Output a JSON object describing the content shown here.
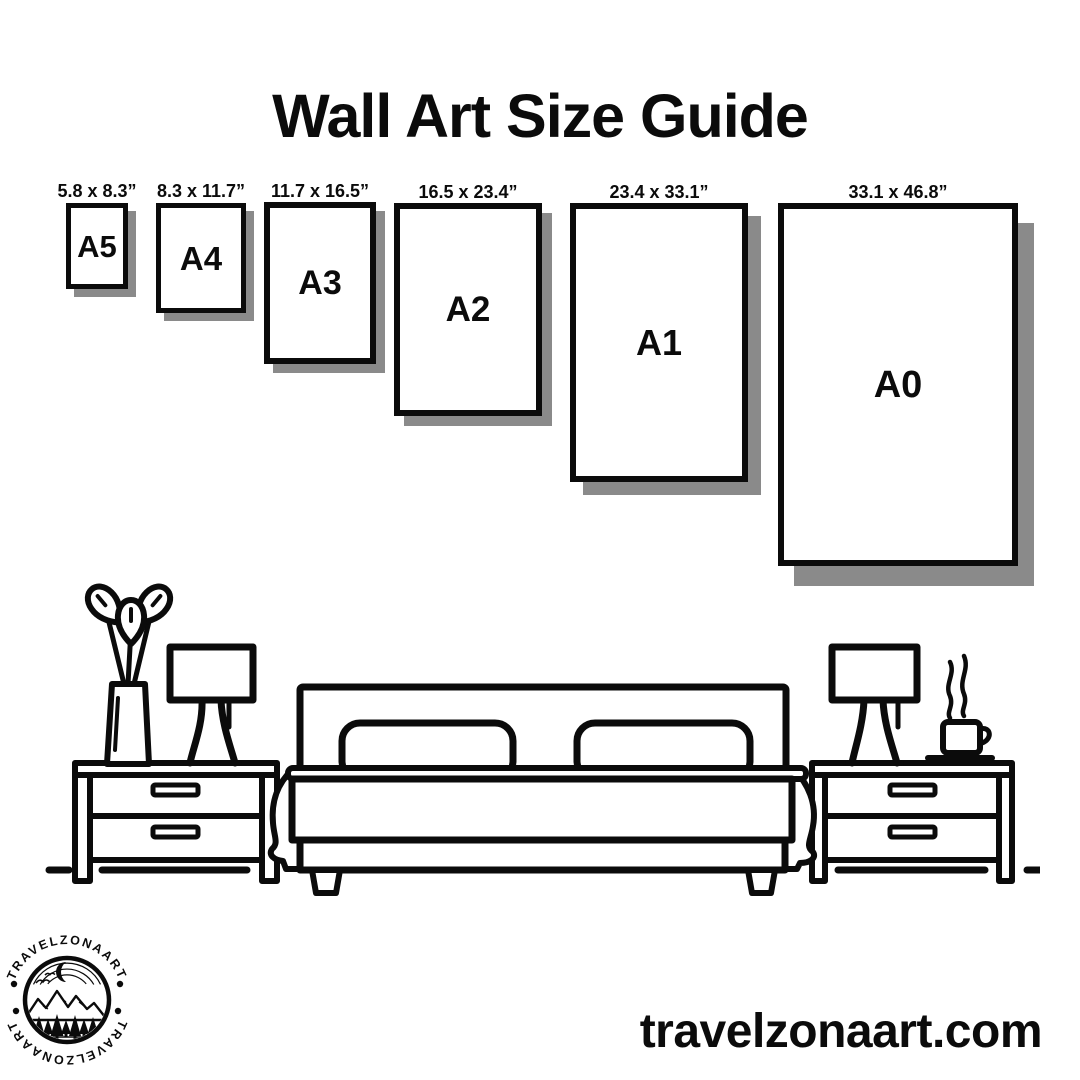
{
  "title": "Wall Art Size Guide",
  "sizes": [
    {
      "code": "A5",
      "dims": "5.8 x 8.3”"
    },
    {
      "code": "A4",
      "dims": "8.3 x 11.7”"
    },
    {
      "code": "A3",
      "dims": "11.7 x 16.5”"
    },
    {
      "code": "A2",
      "dims": "16.5 x 23.4”"
    },
    {
      "code": "A1",
      "dims": "23.4 x 33.1”"
    },
    {
      "code": "A0",
      "dims": "33.1 x 46.8”"
    }
  ],
  "logo": {
    "brand": "TRAVELZONAART"
  },
  "footer": {
    "website": "travelzonaart.com"
  },
  "colors": {
    "ink": "#0b0b0b",
    "shadow": "#8a8a8a",
    "background": "#ffffff"
  },
  "illustration": {
    "description": "Line-art bedroom scene: double bed with two pillows and draped blanket, two 2-drawer nightstands, two table lamps, vase with three leaves, steaming coffee cup on saucer"
  }
}
